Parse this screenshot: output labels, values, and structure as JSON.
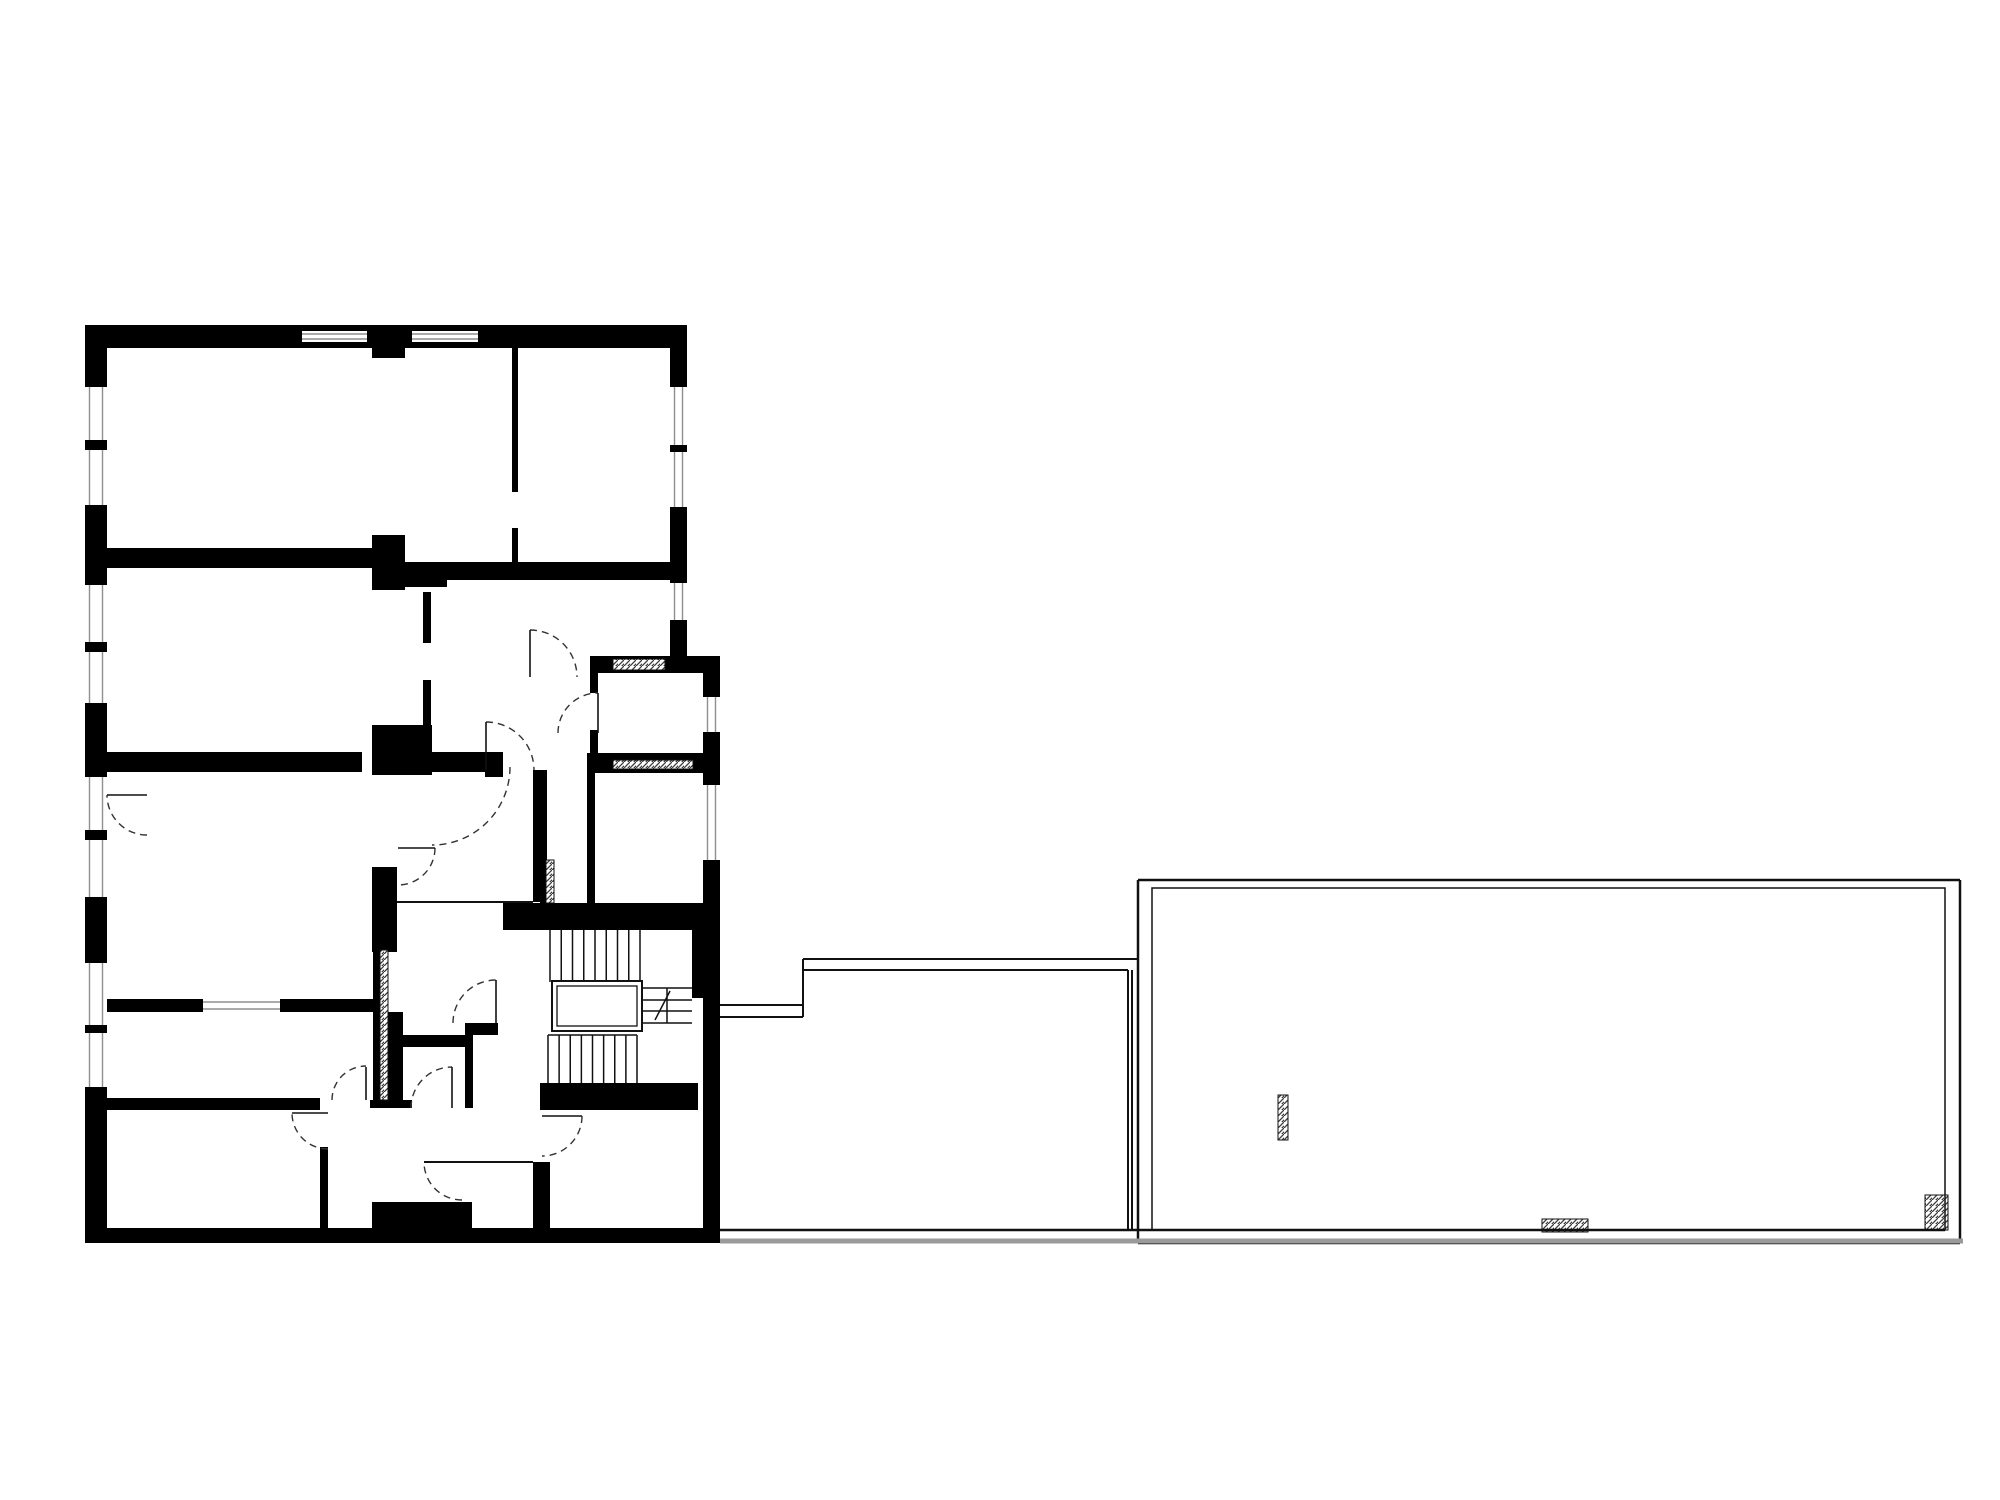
{
  "canvas": {
    "width": 2000,
    "height": 1500,
    "background": "#ffffff"
  },
  "palette": {
    "wall": "#000000",
    "thin_line": "#111111",
    "glass_line": "#8f8f8f",
    "gray_ground_line": "#9a9a9a",
    "door_arc": "#333333",
    "hatch_stroke": "#3a3a3a",
    "white": "#ffffff"
  },
  "plan": {
    "walls_black": [
      [
        85,
        325,
        602,
        23
      ],
      [
        372,
        348,
        33,
        10
      ],
      [
        85,
        325,
        22,
        918
      ],
      [
        85,
        1228,
        635,
        15
      ],
      [
        670,
        325,
        17,
        331
      ],
      [
        590,
        656,
        130,
        17
      ],
      [
        703,
        656,
        17,
        587
      ],
      [
        692,
        930,
        11,
        68
      ],
      [
        587,
        753,
        120,
        20
      ],
      [
        590,
        656,
        8,
        37
      ],
      [
        590,
        730,
        8,
        43
      ],
      [
        587,
        773,
        8,
        130
      ],
      [
        512,
        348,
        6,
        144
      ],
      [
        512,
        528,
        6,
        40
      ],
      [
        107,
        548,
        265,
        20
      ],
      [
        372,
        535,
        33,
        55
      ],
      [
        405,
        562,
        42,
        25
      ],
      [
        447,
        562,
        223,
        18
      ],
      [
        423,
        592,
        8,
        51
      ],
      [
        423,
        680,
        8,
        45
      ],
      [
        107,
        752,
        255,
        20
      ],
      [
        372,
        725,
        60,
        50
      ],
      [
        432,
        752,
        53,
        20
      ],
      [
        485,
        752,
        18,
        25
      ],
      [
        372,
        867,
        25,
        85
      ],
      [
        373,
        950,
        7,
        150
      ],
      [
        388,
        1012,
        15,
        88
      ],
      [
        370,
        1100,
        42,
        8
      ],
      [
        533,
        770,
        14,
        132
      ],
      [
        503,
        903,
        217,
        27
      ],
      [
        107,
        999,
        266,
        13
      ],
      [
        107,
        1098,
        213,
        12
      ],
      [
        320,
        1147,
        8,
        83
      ],
      [
        372,
        1202,
        100,
        28
      ],
      [
        540,
        1083,
        158,
        27
      ],
      [
        533,
        1162,
        17,
        78
      ],
      [
        540,
        860,
        6,
        43
      ],
      [
        403,
        1035,
        62,
        12
      ],
      [
        465,
        1023,
        8,
        85
      ],
      [
        465,
        1023,
        33,
        12
      ]
    ],
    "window_openings_vertical": [
      [
        85,
        387,
        22,
        53
      ],
      [
        85,
        450,
        22,
        55
      ],
      [
        85,
        585,
        22,
        57
      ],
      [
        85,
        652,
        22,
        51
      ],
      [
        85,
        777,
        22,
        53
      ],
      [
        85,
        840,
        22,
        57
      ],
      [
        85,
        963,
        22,
        62
      ],
      [
        85,
        1033,
        22,
        54
      ],
      [
        670,
        387,
        17,
        58
      ],
      [
        670,
        452,
        17,
        55
      ],
      [
        670,
        583,
        17,
        37
      ],
      [
        703,
        697,
        17,
        35
      ],
      [
        703,
        785,
        17,
        75
      ]
    ],
    "window_openings_horizontal": [
      [
        302,
        331,
        65,
        11
      ],
      [
        412,
        331,
        66,
        11
      ],
      [
        203,
        999,
        77,
        13
      ]
    ],
    "hatched_rects": [
      [
        613,
        659,
        52,
        11
      ],
      [
        613,
        760,
        80,
        9
      ],
      [
        380,
        950,
        8,
        150
      ],
      [
        546,
        860,
        8,
        43
      ],
      [
        1278,
        1095,
        10,
        45
      ],
      [
        1542,
        1219,
        46,
        13
      ],
      [
        1925,
        1195,
        23,
        35
      ]
    ],
    "thin_lines": [
      [
        397,
        902,
        533,
        902,
        2
      ],
      [
        424,
        1162,
        533,
        1162,
        2
      ],
      [
        720,
        1005,
        803,
        1005,
        2
      ],
      [
        720,
        1017,
        803,
        1017,
        2
      ],
      [
        803,
        959,
        803,
        1017,
        2
      ],
      [
        803,
        959,
        1138,
        959,
        2
      ],
      [
        803,
        970,
        1128,
        970,
        2
      ],
      [
        1128,
        970,
        1128,
        1230,
        2
      ],
      [
        1132,
        970,
        1132,
        1230,
        2
      ],
      [
        720,
        1230,
        1945,
        1230,
        2.5
      ],
      [
        1138,
        880,
        1960,
        880,
        2.5
      ],
      [
        1960,
        880,
        1960,
        1243,
        2.5
      ],
      [
        1138,
        880,
        1138,
        1243,
        2.5
      ],
      [
        1138,
        1243,
        1960,
        1243,
        2.5
      ],
      [
        548,
        1035,
        637,
        1035,
        1.5
      ]
    ],
    "gray_lines": [
      [
        720,
        1241,
        1963,
        1241,
        5
      ]
    ],
    "outline_rects": [
      {
        "x": 1152,
        "y": 888,
        "w": 793,
        "h": 342,
        "sw": 1.5
      }
    ],
    "stairs": {
      "upper_flight": {
        "x1": 550,
        "x2": 640,
        "y1": 930,
        "y2": 982,
        "treads": 9
      },
      "lower_flight": {
        "x1": 548,
        "x2": 637,
        "y1": 1035,
        "y2": 1083,
        "treads": 9
      },
      "mini_stair": {
        "h_lines": [
          [
            642,
            988,
            692,
            988
          ],
          [
            642,
            1000,
            692,
            1000
          ],
          [
            642,
            1011,
            692,
            1011
          ],
          [
            642,
            1023,
            692,
            1023
          ]
        ],
        "v_line": [
          667,
          988,
          667,
          1023
        ],
        "diagonal": [
          655,
          1020,
          670,
          991
        ]
      }
    },
    "elevator": {
      "outer": [
        552,
        981,
        90,
        50
      ],
      "inner": [
        557,
        986,
        80,
        40
      ]
    },
    "doors": [
      {
        "cx": 530,
        "cy": 677,
        "r": 47,
        "a1": 270,
        "a2": 360,
        "leaf": [
          530,
          630,
          530,
          677
        ]
      },
      {
        "cx": 486,
        "cy": 770,
        "r": 48,
        "a1": 270,
        "a2": 360,
        "leaf": [
          486,
          722,
          486,
          770
        ]
      },
      {
        "cx": 398,
        "cy": 848,
        "r": 37,
        "a1": 0,
        "a2": 90,
        "leaf": [
          398,
          848,
          435,
          848
        ]
      },
      {
        "cx": 147,
        "cy": 795,
        "r": 40,
        "a1": 90,
        "a2": 180,
        "leaf": [
          107,
          795,
          147,
          795
        ]
      },
      {
        "cx": 598,
        "cy": 733,
        "r": 40,
        "a1": 180,
        "a2": 270,
        "leaf": [
          598,
          693,
          598,
          733
        ]
      },
      {
        "cx": 432,
        "cy": 767,
        "r": 78,
        "a1": 0,
        "a2": 90,
        "leaf": null
      },
      {
        "cx": 366,
        "cy": 1100,
        "r": 34,
        "a1": 180,
        "a2": 270,
        "leaf": [
          366,
          1067,
          366,
          1100
        ]
      },
      {
        "cx": 328,
        "cy": 1113,
        "r": 36,
        "a1": 90,
        "a2": 180,
        "leaf": [
          292,
          1113,
          328,
          1113
        ]
      },
      {
        "cx": 462,
        "cy": 1162,
        "r": 38,
        "a1": 90,
        "a2": 180,
        "leaf": null
      },
      {
        "cx": 542,
        "cy": 1116,
        "r": 40,
        "a1": 0,
        "a2": 90,
        "leaf": [
          542,
          1116,
          582,
          1116
        ]
      },
      {
        "cx": 496,
        "cy": 1023,
        "r": 43,
        "a1": 180,
        "a2": 270,
        "leaf": [
          496,
          980,
          496,
          1023
        ]
      },
      {
        "cx": 452,
        "cy": 1108,
        "r": 41,
        "a1": 180,
        "a2": 270,
        "leaf": [
          452,
          1067,
          452,
          1108
        ]
      }
    ],
    "glazing_inset": 4.5,
    "door_dash": "7 5"
  }
}
